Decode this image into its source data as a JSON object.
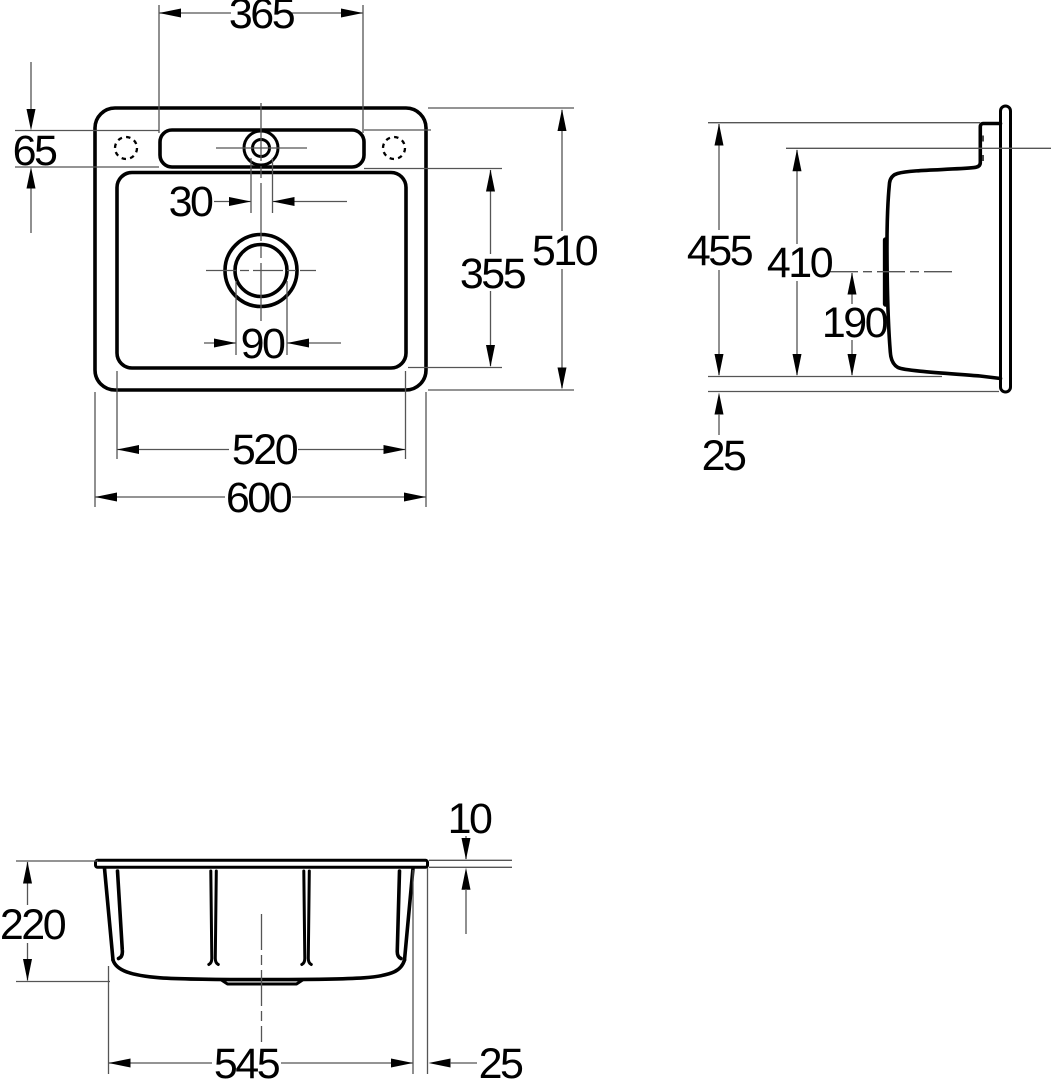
{
  "title": "Sink dimension drawing, three orthographic views",
  "units": "mm",
  "views": {
    "plan": {
      "ledge_width": "365",
      "ledge_depth": "65",
      "tap_hole": "30",
      "basin_depth": "355",
      "overall_depth": "510",
      "drain_diameter": "90",
      "basin_width": "520",
      "overall_width": "600"
    },
    "side": {
      "overall_height": "455",
      "basin_top_height": "410",
      "drain_center_height": "190",
      "flange_offset": "25"
    },
    "front": {
      "rim_thickness": "10",
      "bowl_depth": "220",
      "body_width": "545",
      "rim_overhang": "25"
    }
  },
  "colors": {
    "object_line": "#000000",
    "dimension_line": "#555555",
    "background": "#ffffff"
  }
}
